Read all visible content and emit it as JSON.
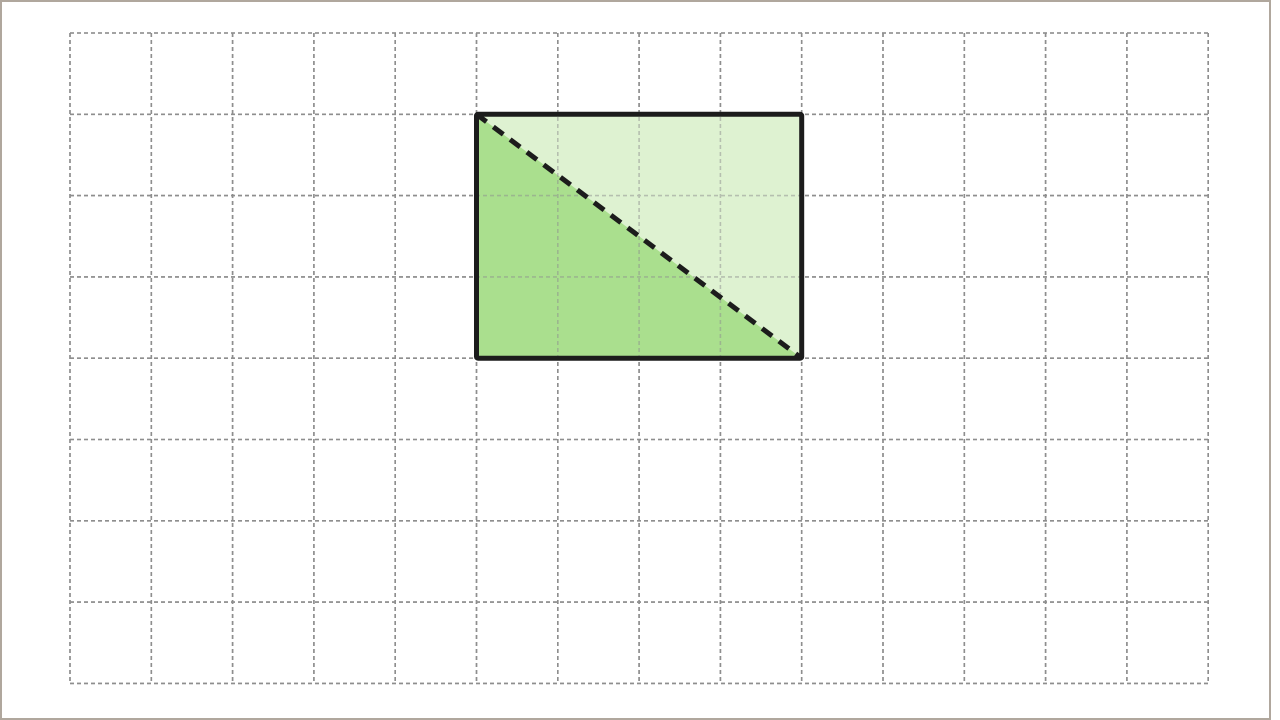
{
  "canvas": {
    "width": 1280,
    "height": 720,
    "background_color": "#ffffff"
  },
  "frame": {
    "width": 1271,
    "height": 720,
    "thickness": 2,
    "color": "#b0a79d"
  },
  "grid": {
    "origin_x": 70,
    "origin_y": 33,
    "cols": 14,
    "rows": 8,
    "cell_size": 81.3,
    "line_color": "#8e8e8e",
    "line_width": 1.6,
    "dash_pattern": "4 3",
    "overlay_opacity": 0.5
  },
  "shape": {
    "type": "rectangle-with-dashed-diagonal",
    "grid_col": 5,
    "grid_row": 1,
    "width_cells": 4,
    "height_cells": 3,
    "x": 476.5,
    "y": 114.3,
    "width": 325.2,
    "height": 243.9,
    "border_color": "#1c1c1c",
    "border_width": 5,
    "upper_right_fill": "#def2d1",
    "lower_left_fill": "#aadf8e",
    "diagonal": {
      "from": "top-left-corner",
      "to": "bottom-right-corner",
      "color": "#1c1c1c",
      "width": 5,
      "dash_pattern": "12.5 8.5"
    }
  }
}
